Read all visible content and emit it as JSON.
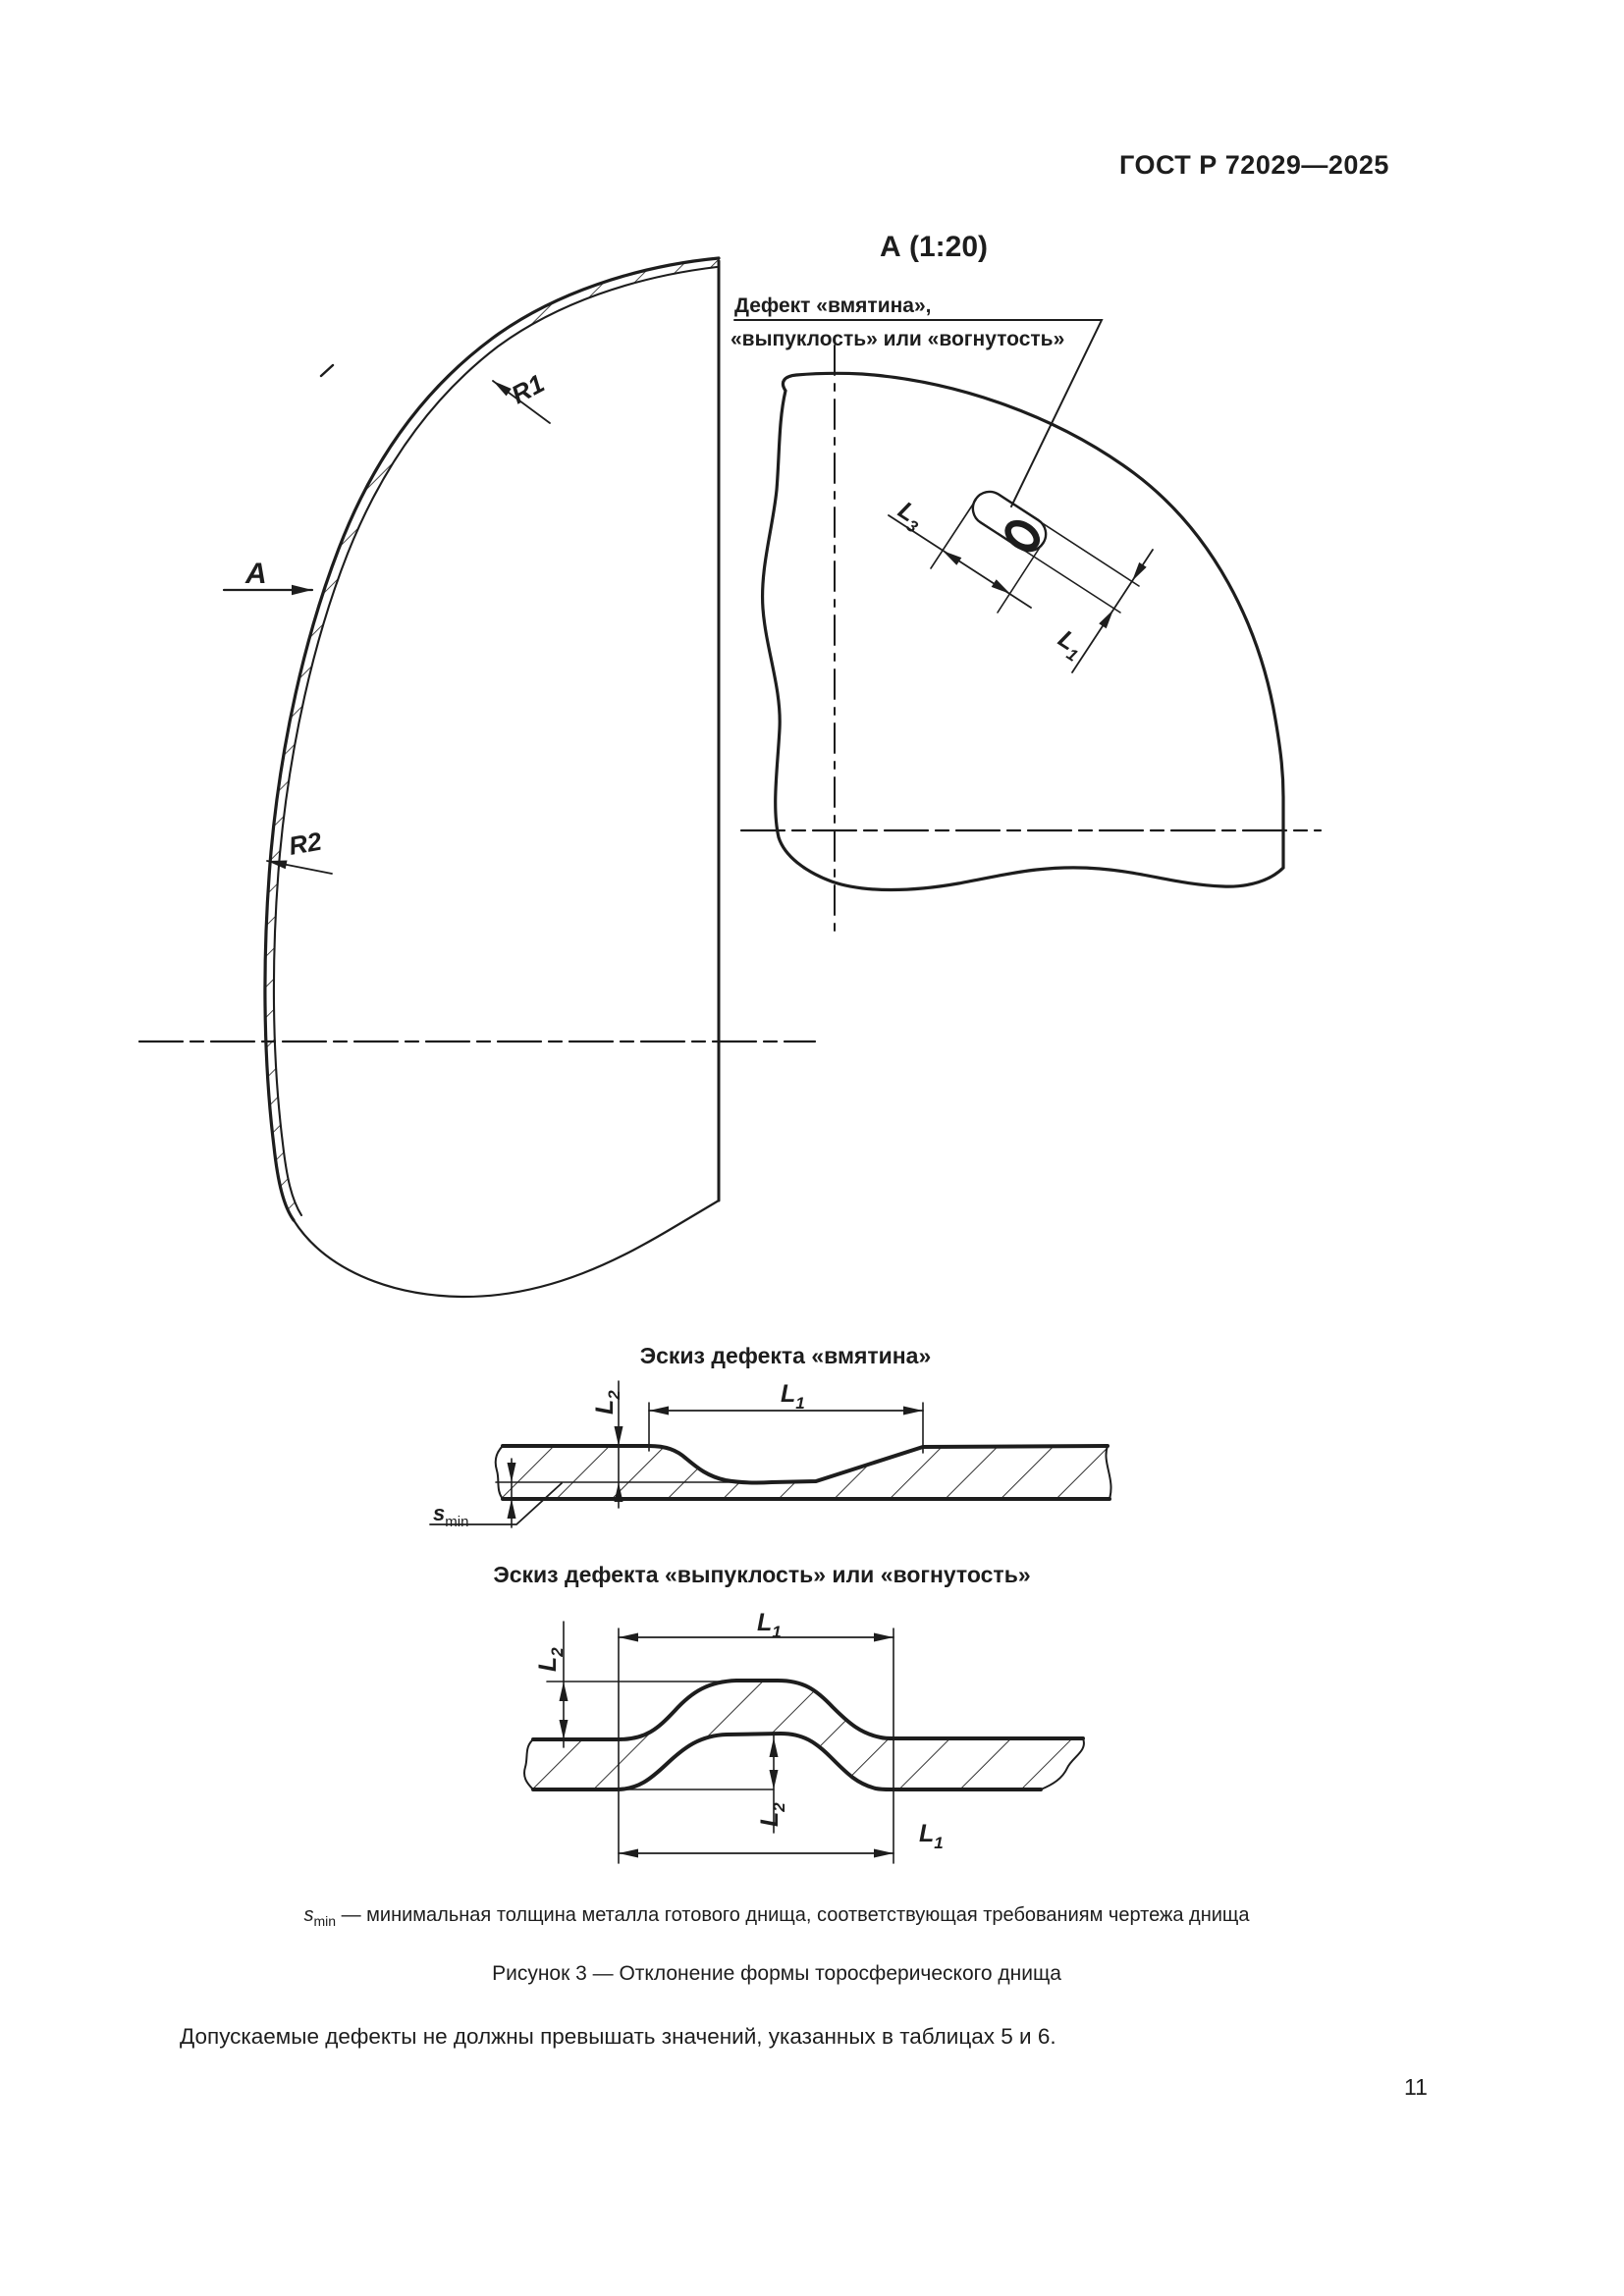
{
  "page": {
    "header_title": "ГОСТ Р 72029—2025",
    "page_number": "11",
    "smin_note_text": " — минимальная толщина металла готового днища, соответствующая требованиям чертежа днища",
    "figure_caption": "Рисунок 3 — Отклонение формы торосферического днища",
    "body_paragraph": "Допускаемые дефекты не должны превышать значений, указанных в таблицах 5 и 6."
  },
  "drawing": {
    "view_label": "А (1:20)",
    "callout_line1": "Дефект «вмятина»,",
    "callout_line2": "«выпуклость» или «вогнутость»",
    "section_view_letter": "А",
    "radius1": "R1",
    "radius2": "R2",
    "sketch_dent_title": "Эскиз дефекта «вмятина»",
    "sketch_bulge_title": "Эскиз дефекта «выпуклость» или «вогнутость»",
    "dims": {
      "L1": {
        "base": "L",
        "sub": "1"
      },
      "L2": {
        "base": "L",
        "sub": "2"
      },
      "L3": {
        "base": "L",
        "sub": "3"
      },
      "smin": {
        "base": "s",
        "sub": "min"
      }
    }
  }
}
